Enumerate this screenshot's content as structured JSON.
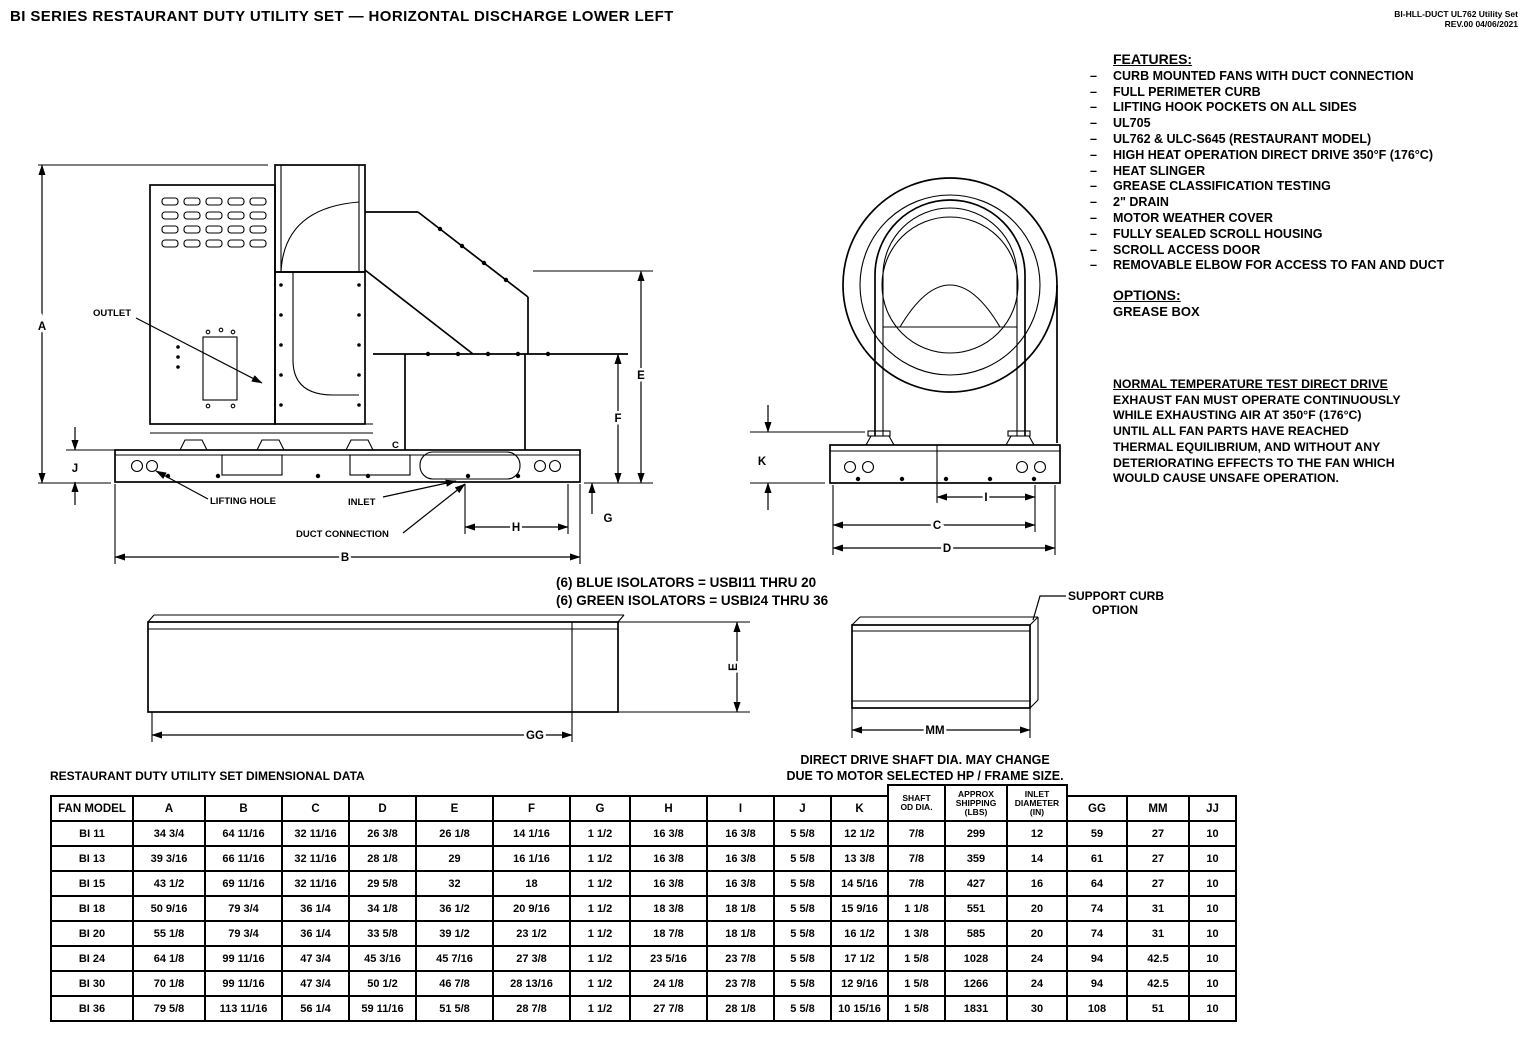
{
  "header": {
    "title": "BI SERIES RESTAURANT DUTY UTILITY SET — HORIZONTAL DISCHARGE LOWER LEFT",
    "doc_ref_line1": "BI-HLL-DUCT UL762 Utility Set",
    "doc_ref_line2": "REV.00   04/06/2021"
  },
  "features": {
    "heading": "FEATURES:",
    "items": [
      "CURB MOUNTED FANS WITH DUCT CONNECTION",
      "FULL PERIMETER CURB",
      "LIFTING HOOK POCKETS ON ALL SIDES",
      "UL705",
      "UL762 & ULC-S645 (RESTAURANT MODEL)",
      "HIGH HEAT OPERATION DIRECT DRIVE 350°F (176°C)",
      "HEAT SLINGER",
      "GREASE CLASSIFICATION TESTING",
      "2\" DRAIN",
      "MOTOR WEATHER COVER",
      "FULLY SEALED SCROLL HOUSING",
      "SCROLL ACCESS DOOR",
      "REMOVABLE ELBOW FOR ACCESS TO FAN AND DUCT"
    ]
  },
  "options": {
    "heading": "OPTIONS:",
    "items": [
      "GREASE BOX"
    ]
  },
  "normal_temp_note": {
    "heading": "NORMAL TEMPERATURE TEST DIRECT DRIVE",
    "lines": [
      "EXHAUST FAN MUST OPERATE CONTINUOUSLY",
      "WHILE EXHAUSTING AIR AT 350°F (176°C)",
      "UNTIL ALL FAN PARTS HAVE REACHED",
      "THERMAL EQUILIBRIUM, AND WITHOUT ANY",
      "DETERIORATING EFFECTS TO THE FAN WHICH",
      "WOULD CAUSE UNSAFE OPERATION."
    ]
  },
  "isolator_notes": [
    "(6) BLUE ISOLATORS = USBI11 THRU 20",
    "(6) GREEN ISOLATORS = USBI24 THRU 36"
  ],
  "shaft_note": [
    "DIRECT DRIVE SHAFT DIA. MAY CHANGE",
    "DUE TO MOTOR SELECTED HP / FRAME SIZE."
  ],
  "drawings": {
    "outlet": "OUTLET",
    "lifting_hole": "LIFTING HOLE",
    "inlet": "INLET",
    "duct_connection": "DUCT CONNECTION",
    "support_curb_line1": "SUPPORT CURB",
    "support_curb_line2": "OPTION",
    "dim_a": "A",
    "dim_b": "B",
    "dim_c": "C",
    "dim_c_side": "C",
    "dim_d": "D",
    "dim_e": "E",
    "dim_e_curb": "E",
    "dim_f": "F",
    "dim_g": "G",
    "dim_h": "H",
    "dim_i": "I",
    "dim_j": "J",
    "dim_k": "K",
    "dim_gg": "GG",
    "dim_mm": "MM"
  },
  "table": {
    "title": "RESTAURANT DUTY UTILITY SET DIMENSIONAL DATA",
    "columns": [
      "FAN MODEL",
      "A",
      "B",
      "C",
      "D",
      "E",
      "F",
      "G",
      "H",
      "I",
      "J",
      "K",
      "SHAFT\nOD DIA.",
      "APPROX\nSHIPPING\n(LBS)",
      "INLET\nDIAMETER\n(IN)",
      "GG",
      "MM",
      "JJ"
    ],
    "rows": [
      [
        "BI 11",
        "34 3/4",
        "64 11/16",
        "32 11/16",
        "26 3/8",
        "26 1/8",
        "14 1/16",
        "1 1/2",
        "16 3/8",
        "16 3/8",
        "5 5/8",
        "12 1/2",
        "7/8",
        "299",
        "12",
        "59",
        "27",
        "10"
      ],
      [
        "BI 13",
        "39 3/16",
        "66 11/16",
        "32 11/16",
        "28 1/8",
        "29",
        "16 1/16",
        "1 1/2",
        "16 3/8",
        "16 3/8",
        "5 5/8",
        "13 3/8",
        "7/8",
        "359",
        "14",
        "61",
        "27",
        "10"
      ],
      [
        "BI 15",
        "43 1/2",
        "69 11/16",
        "32 11/16",
        "29 5/8",
        "32",
        "18",
        "1 1/2",
        "16 3/8",
        "16 3/8",
        "5 5/8",
        "14 5/16",
        "7/8",
        "427",
        "16",
        "64",
        "27",
        "10"
      ],
      [
        "BI 18",
        "50 9/16",
        "79 3/4",
        "36 1/4",
        "34 1/8",
        "36 1/2",
        "20 9/16",
        "1 1/2",
        "18 3/8",
        "18 1/8",
        "5 5/8",
        "15 9/16",
        "1 1/8",
        "551",
        "20",
        "74",
        "31",
        "10"
      ],
      [
        "BI 20",
        "55 1/8",
        "79 3/4",
        "36 1/4",
        "33 5/8",
        "39 1/2",
        "23 1/2",
        "1 1/2",
        "18 7/8",
        "18 1/8",
        "5 5/8",
        "16 1/2",
        "1 3/8",
        "585",
        "20",
        "74",
        "31",
        "10"
      ],
      [
        "BI 24",
        "64 1/8",
        "99 11/16",
        "47 3/4",
        "45 3/16",
        "45 7/16",
        "27 3/8",
        "1 1/2",
        "23 5/16",
        "23 7/8",
        "5 5/8",
        "17 1/2",
        "1 5/8",
        "1028",
        "24",
        "94",
        "42.5",
        "10"
      ],
      [
        "BI 30",
        "70 1/8",
        "99 11/16",
        "47 3/4",
        "50 1/2",
        "46 7/8",
        "28 13/16",
        "1 1/2",
        "24 1/8",
        "23 7/8",
        "5 5/8",
        "12 9/16",
        "1 5/8",
        "1266",
        "24",
        "94",
        "42.5",
        "10"
      ],
      [
        "BI 36",
        "79 5/8",
        "113 11/16",
        "56 1/4",
        "59 11/16",
        "51 5/8",
        "28 7/8",
        "1 1/2",
        "27 7/8",
        "28 1/8",
        "5 5/8",
        "10 15/16",
        "1 5/8",
        "1831",
        "30",
        "108",
        "51",
        "10"
      ]
    ]
  }
}
